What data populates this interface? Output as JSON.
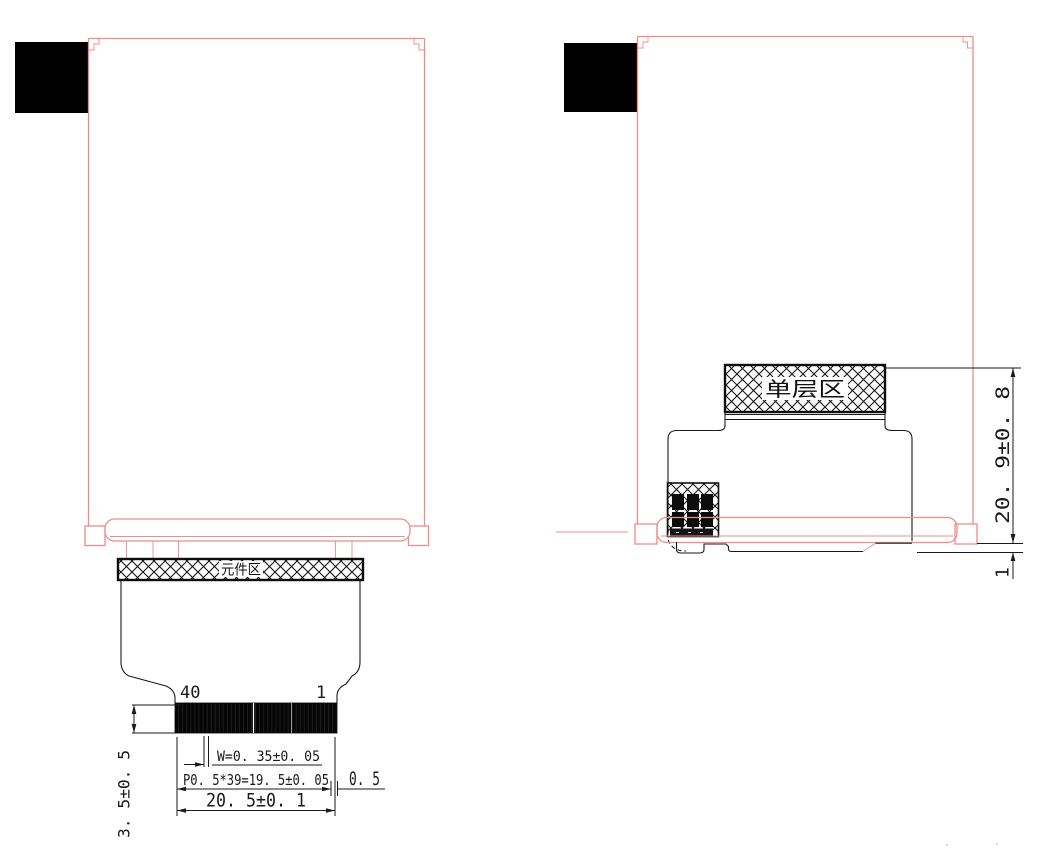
{
  "front_view": {
    "component_area_label": "元件区",
    "pin_first": "40",
    "pin_last": "1",
    "dim_pin_width": "W=0. 35±0. 05",
    "dim_pin_pitch": "P0. 5*39=19. 5±0. 05",
    "dim_edge_margin": "0. 5",
    "dim_connector_width": "20. 5±0. 1",
    "dim_connector_depth": "3. 5±0. 5"
  },
  "side_view": {
    "single_layer_area_label": "单层区",
    "dim_fpc_fold_height": "20. 9±0. 8",
    "dim_bottom_clearance": "1"
  },
  "colors": {
    "panel_outline_pink": "#ef8c89",
    "drawing_black": "#1a1a1a"
  }
}
